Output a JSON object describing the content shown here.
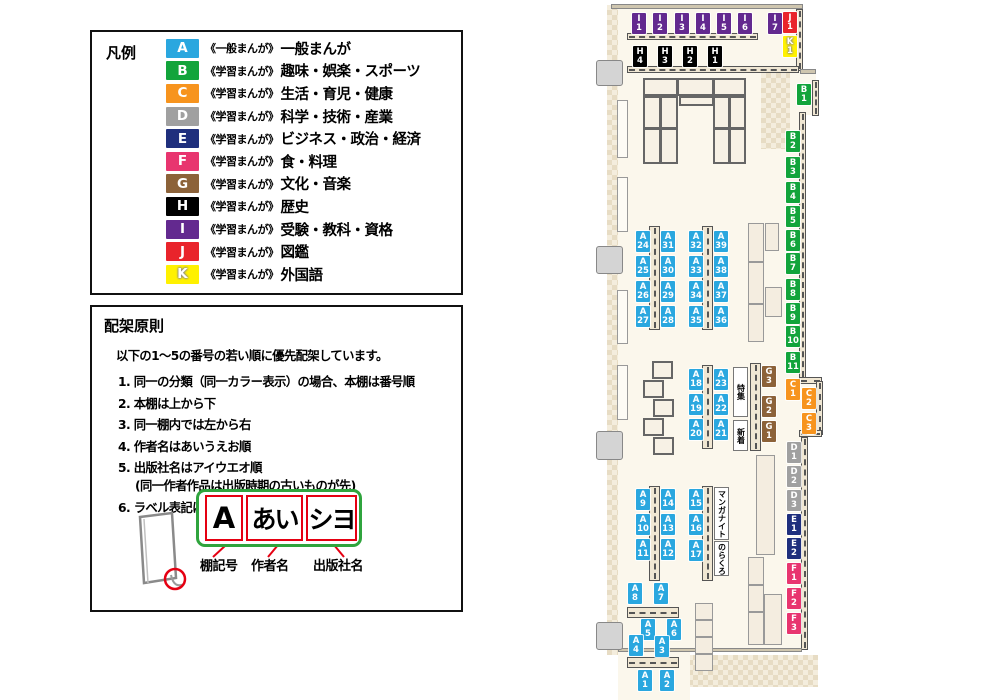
{
  "legend": {
    "title": "凡例",
    "items": [
      {
        "code": "A",
        "color": "#2AA7DF",
        "series": "《一般まんが》",
        "label": "一般まんが",
        "outline": false
      },
      {
        "code": "B",
        "color": "#12A43B",
        "series": "《学習まんが》",
        "label": "趣味・娯楽・スポーツ",
        "outline": false
      },
      {
        "code": "C",
        "color": "#F7941E",
        "series": "《学習まんが》",
        "label": "生活・育児・健康",
        "outline": false
      },
      {
        "code": "D",
        "color": "#A0A0A0",
        "series": "《学習まんが》",
        "label": "科学・技術・産業",
        "outline": false
      },
      {
        "code": "E",
        "color": "#1F2F7D",
        "series": "《学習まんが》",
        "label": "ビジネス・政治・経済",
        "outline": false
      },
      {
        "code": "F",
        "color": "#E8356F",
        "series": "《学習まんが》",
        "label": "食・料理",
        "outline": false
      },
      {
        "code": "G",
        "color": "#8C6239",
        "series": "《学習まんが》",
        "label": "文化・音楽",
        "outline": false
      },
      {
        "code": "H",
        "color": "#000000",
        "series": "《学習まんが》",
        "label": "歴史",
        "outline": false
      },
      {
        "code": "I",
        "color": "#63298F",
        "series": "《学習まんが》",
        "label": "受験・教科・資格",
        "outline": false
      },
      {
        "code": "J",
        "color": "#E9242B",
        "series": "《学習まんが》",
        "label": "図鑑",
        "outline": false
      },
      {
        "code": "K",
        "color": "#FFF100",
        "series": "《学習まんが》",
        "label": "外国語",
        "outline": true
      }
    ]
  },
  "principles": {
    "title": "配架原則",
    "intro": "以下の1～5の番号の若い順に優先配架しています。",
    "rules": [
      {
        "num": "1.",
        "text": "同一の分類（同一カラー表示）の場合、本棚は番号順",
        "sub": ""
      },
      {
        "num": "2.",
        "text": "本棚は上から下",
        "sub": ""
      },
      {
        "num": "3.",
        "text": "同一棚内では左から右",
        "sub": ""
      },
      {
        "num": "4.",
        "text": "作者名はあいうえお順",
        "sub": ""
      },
      {
        "num": "5.",
        "text": "出版社名はアイウエオ順",
        "sub": "(同一作者作品は出版時期の古いものが先)"
      },
      {
        "num": "6.",
        "text": "ラベル表記は下図の通り",
        "sub": ""
      }
    ],
    "label_diagram": {
      "boxes": [
        "A",
        "あい",
        "シヨ"
      ],
      "captions": [
        "棚記号",
        "作者名",
        "出版社名"
      ]
    }
  },
  "map": {
    "colors": {
      "A": "#2AA7DF",
      "B": "#12A43B",
      "C": "#F7941E",
      "D": "#A0A0A0",
      "E": "#1F2F7D",
      "F": "#E8356F",
      "G": "#8C6239",
      "H": "#000000",
      "I": "#63298F",
      "J": "#E9242B",
      "K": "#FFF100"
    },
    "signs": [
      {
        "text": "特集",
        "x": 733,
        "y": 367,
        "w": 15,
        "h": 50
      },
      {
        "text": "新着",
        "x": 733,
        "y": 420,
        "w": 15,
        "h": 31
      },
      {
        "text": "マンガナイト",
        "x": 714,
        "y": 487,
        "w": 15,
        "h": 53
      },
      {
        "text": "のらくろ",
        "x": 714,
        "y": 541,
        "w": 15,
        "h": 35
      }
    ],
    "labels": [
      {
        "id": "I1",
        "x": 632,
        "y": 13
      },
      {
        "id": "I2",
        "x": 653,
        "y": 13
      },
      {
        "id": "I3",
        "x": 675,
        "y": 13
      },
      {
        "id": "I4",
        "x": 696,
        "y": 13
      },
      {
        "id": "I5",
        "x": 717,
        "y": 13
      },
      {
        "id": "I6",
        "x": 738,
        "y": 13
      },
      {
        "id": "I7",
        "x": 768,
        "y": 13
      },
      {
        "id": "J1",
        "x": 783,
        "y": 12
      },
      {
        "id": "K1",
        "x": 783,
        "y": 36
      },
      {
        "id": "H4",
        "x": 633,
        "y": 46
      },
      {
        "id": "H3",
        "x": 658,
        "y": 46
      },
      {
        "id": "H2",
        "x": 683,
        "y": 46
      },
      {
        "id": "H1",
        "x": 708,
        "y": 46
      },
      {
        "id": "B1",
        "x": 797,
        "y": 84
      },
      {
        "id": "B2",
        "x": 786,
        "y": 131
      },
      {
        "id": "B3",
        "x": 786,
        "y": 157
      },
      {
        "id": "B4",
        "x": 786,
        "y": 182
      },
      {
        "id": "B5",
        "x": 786,
        "y": 206
      },
      {
        "id": "B6",
        "x": 786,
        "y": 230
      },
      {
        "id": "B7",
        "x": 786,
        "y": 253
      },
      {
        "id": "B8",
        "x": 786,
        "y": 279
      },
      {
        "id": "B9",
        "x": 786,
        "y": 303
      },
      {
        "id": "B10",
        "x": 786,
        "y": 326
      },
      {
        "id": "B11",
        "x": 786,
        "y": 352
      },
      {
        "id": "C1",
        "x": 786,
        "y": 379
      },
      {
        "id": "C2",
        "x": 802,
        "y": 388
      },
      {
        "id": "C3",
        "x": 802,
        "y": 413
      },
      {
        "id": "D1",
        "x": 787,
        "y": 442
      },
      {
        "id": "D2",
        "x": 787,
        "y": 466
      },
      {
        "id": "D3",
        "x": 787,
        "y": 490
      },
      {
        "id": "E1",
        "x": 787,
        "y": 514
      },
      {
        "id": "E2",
        "x": 787,
        "y": 538
      },
      {
        "id": "F1",
        "x": 787,
        "y": 563
      },
      {
        "id": "F2",
        "x": 787,
        "y": 588
      },
      {
        "id": "F3",
        "x": 787,
        "y": 613
      },
      {
        "id": "A24",
        "x": 636,
        "y": 231
      },
      {
        "id": "A25",
        "x": 636,
        "y": 256
      },
      {
        "id": "A26",
        "x": 636,
        "y": 281
      },
      {
        "id": "A27",
        "x": 636,
        "y": 306
      },
      {
        "id": "A31",
        "x": 661,
        "y": 231
      },
      {
        "id": "A30",
        "x": 661,
        "y": 256
      },
      {
        "id": "A29",
        "x": 661,
        "y": 281
      },
      {
        "id": "A28",
        "x": 661,
        "y": 306
      },
      {
        "id": "A32",
        "x": 689,
        "y": 231
      },
      {
        "id": "A33",
        "x": 689,
        "y": 256
      },
      {
        "id": "A34",
        "x": 689,
        "y": 281
      },
      {
        "id": "A35",
        "x": 689,
        "y": 306
      },
      {
        "id": "A39",
        "x": 714,
        "y": 231
      },
      {
        "id": "A38",
        "x": 714,
        "y": 256
      },
      {
        "id": "A37",
        "x": 714,
        "y": 281
      },
      {
        "id": "A36",
        "x": 714,
        "y": 306
      },
      {
        "id": "A18",
        "x": 689,
        "y": 369
      },
      {
        "id": "A19",
        "x": 689,
        "y": 394
      },
      {
        "id": "A20",
        "x": 689,
        "y": 419
      },
      {
        "id": "A23",
        "x": 714,
        "y": 369
      },
      {
        "id": "A22",
        "x": 714,
        "y": 394
      },
      {
        "id": "A21",
        "x": 714,
        "y": 419
      },
      {
        "id": "G3",
        "x": 762,
        "y": 366
      },
      {
        "id": "G2",
        "x": 762,
        "y": 396
      },
      {
        "id": "G1",
        "x": 762,
        "y": 421
      },
      {
        "id": "A9",
        "x": 636,
        "y": 489
      },
      {
        "id": "A10",
        "x": 636,
        "y": 514
      },
      {
        "id": "A11",
        "x": 636,
        "y": 539
      },
      {
        "id": "A14",
        "x": 661,
        "y": 489
      },
      {
        "id": "A13",
        "x": 661,
        "y": 514
      },
      {
        "id": "A12",
        "x": 661,
        "y": 539
      },
      {
        "id": "A15",
        "x": 689,
        "y": 489
      },
      {
        "id": "A16",
        "x": 689,
        "y": 514
      },
      {
        "id": "A17",
        "x": 689,
        "y": 540
      },
      {
        "id": "A8",
        "x": 628,
        "y": 583
      },
      {
        "id": "A7",
        "x": 654,
        "y": 583
      },
      {
        "id": "A5",
        "x": 641,
        "y": 619
      },
      {
        "id": "A6",
        "x": 667,
        "y": 619
      },
      {
        "id": "A4",
        "x": 629,
        "y": 635
      },
      {
        "id": "A3",
        "x": 655,
        "y": 636
      },
      {
        "id": "A1",
        "x": 638,
        "y": 670
      },
      {
        "id": "A2",
        "x": 660,
        "y": 670
      }
    ]
  }
}
